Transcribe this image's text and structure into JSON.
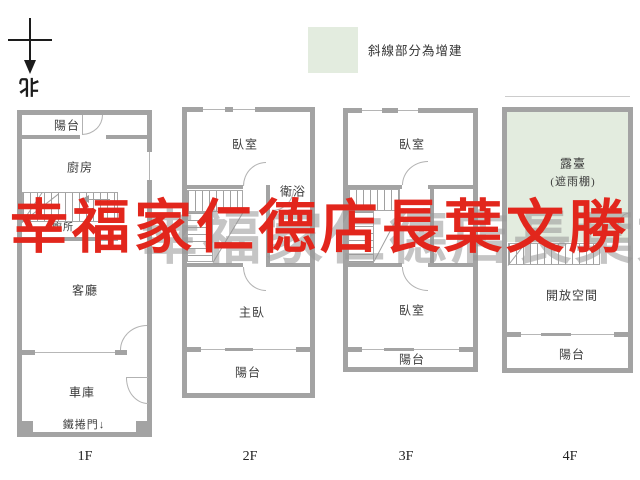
{
  "colors": {
    "addition_green": "#e3ecdf",
    "watermark_red": "#e2261c",
    "wall_gray": "#a3a3a3"
  },
  "compass": {
    "north_label": "北"
  },
  "legend": {
    "note": "斜線部分為增建"
  },
  "watermark": {
    "text": "幸福家仁德店長葉文勝"
  },
  "floors": [
    {
      "label": "1F",
      "balcony": "陽台",
      "kitchen": "廚房",
      "toilet": "廁所",
      "living_room": "客廳",
      "garage": "車庫",
      "roller_door": "鐵捲門↓"
    },
    {
      "label": "2F",
      "bedroom": "臥室",
      "bathroom": "衛浴",
      "master_bedroom": "主臥",
      "balcony": "陽台"
    },
    {
      "label": "3F",
      "bedroom_front": "臥室",
      "bedroom_rear": "臥室",
      "balcony": "陽台"
    },
    {
      "label": "4F",
      "terrace": "露臺",
      "terrace_note": "(遮雨棚)",
      "open_space": "開放空間",
      "balcony": "陽台"
    }
  ]
}
